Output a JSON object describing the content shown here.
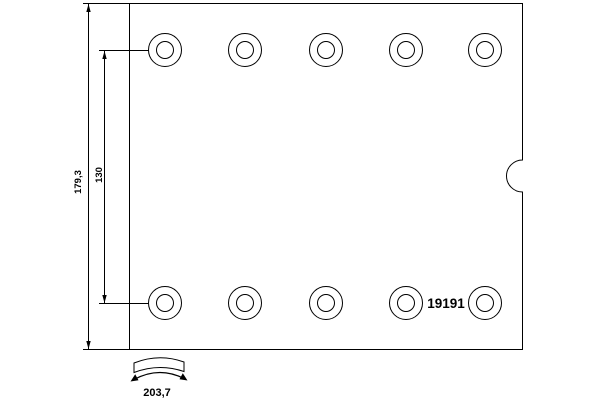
{
  "drawing": {
    "part_number": "19191",
    "dimensions": {
      "overall_height": "179,3",
      "hole_row_spacing": "130",
      "arc_length": "203,7"
    },
    "line_color": "#000000",
    "background_color": "#ffffff"
  }
}
